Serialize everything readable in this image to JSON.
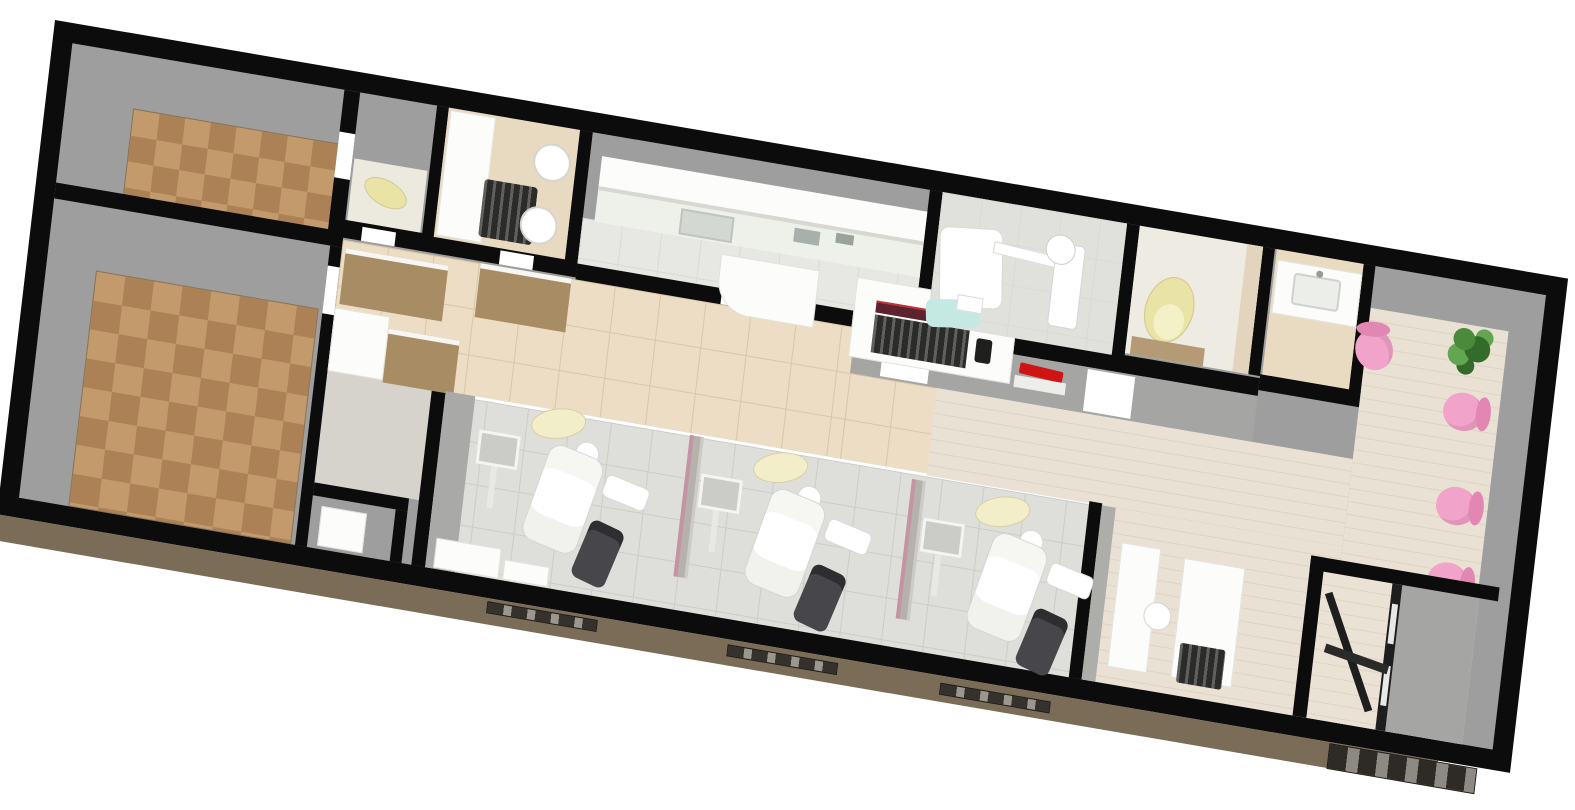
{
  "scene": {
    "type": "3d-floorplan-render",
    "description": "Axonometric 3D rendering of a dental clinic floor plan, long building rotated about 10 degrees, black walls with gray inner wall faces, no text labels visible",
    "rotation_deg": 9.7
  },
  "colors": {
    "wall": "#0c0c0c",
    "face": "#9e9e9e",
    "half-wall": "#a5a5a3",
    "carpet-a": "#c29a6b",
    "carpet-b": "#ab8155",
    "tile-beige": "#ecddc4",
    "tile-beige-line": "#d9c6a9",
    "tile-gray": "#dededb",
    "tile-gray-line": "#cbcbc7",
    "plank": "#e9e1d3",
    "plank-line": "#ded4c3",
    "lab-floor": "#e7e7e3",
    "branch-floor": "#d6d3cd",
    "white": "#fcfcfa",
    "counter": "#eef0ea",
    "sink": "#d3d8d2",
    "wood": "#a88c63",
    "pink": "#f2a3c9",
    "pink-dark": "#e287b4",
    "green": "#4b8a3a",
    "green-dark": "#336b2b",
    "green-light": "#63a551",
    "toilet-yellow": "#e9e4a6",
    "toilet-yellow-light": "#f4f0c8",
    "red": "#cf1414",
    "maroon": "#5c2230",
    "cyan": "#c4e9e3",
    "dark-equip": "#2b2b29",
    "cart": "#47474b",
    "ext-base": "#7b6c57",
    "mat-brown": "#b59a76",
    "partition": "#b5b2ae",
    "partition-pink": "#c593a3"
  },
  "rooms": [
    {
      "id": "office-upper-left",
      "floor": "brown checkered carpet over gray",
      "furniture": []
    },
    {
      "id": "office-lower-left",
      "floor": "brown checkered carpet over gray",
      "furniture": []
    },
    {
      "id": "staff-wc",
      "floor": "pale tile",
      "furniture": [
        "yellow toilet"
      ]
    },
    {
      "id": "basin-room",
      "floor": "beige tile",
      "furniture": [
        "white counter",
        "dark cabinet",
        "round basin",
        "round basin"
      ]
    },
    {
      "id": "lab-sterilization",
      "floor": "pale gridded tile",
      "furniture": [
        "upper cabinet row",
        "counter with sink",
        "small appliances",
        "pass-through table",
        "sterilizer cabinet with dark unit and maroon tray"
      ]
    },
    {
      "id": "xray-room",
      "floor": "gray gridded tile",
      "furniture": [
        "white couch",
        "panoramic x-ray unit",
        "cyan chair"
      ]
    },
    {
      "id": "patient-wc",
      "floor": "pale tile",
      "furniture": [
        "yellow toilet",
        "brown mat"
      ]
    },
    {
      "id": "powder-room",
      "floor": "beige tile",
      "furniture": [
        "vanity counter with sink"
      ]
    },
    {
      "id": "corridor",
      "floor": "beige tile",
      "furniture": [
        "wood cabinet",
        "wood cabinet",
        "wood cabinet",
        "white counter",
        "washer box"
      ]
    },
    {
      "id": "treatment-area",
      "floor": "light gray tile",
      "bays": 3,
      "furniture": [
        "dental chair",
        "overhead light",
        "monitor arm",
        "delivery table",
        "assistant cart",
        "partition",
        "partition",
        "white cabinets"
      ]
    },
    {
      "id": "waiting-hall",
      "floor": "beige plank",
      "chairs": 4,
      "furniture": [
        "potted plant",
        "red wall item",
        "half wall with door openings"
      ]
    },
    {
      "id": "reception",
      "floor": "beige plank",
      "furniture": [
        "counter slab",
        "counter slab",
        "round stool",
        "dark equipment"
      ]
    },
    {
      "id": "entry-vestibule",
      "floor": "beige plank",
      "furniture": [
        "glass door partition",
        "angled glass door",
        "exterior mat"
      ]
    }
  ],
  "exterior": {
    "base_color_name": "brown plinth along bottom facade",
    "windows": 3,
    "entry_mat": "dark checkered mat at bottom right"
  }
}
